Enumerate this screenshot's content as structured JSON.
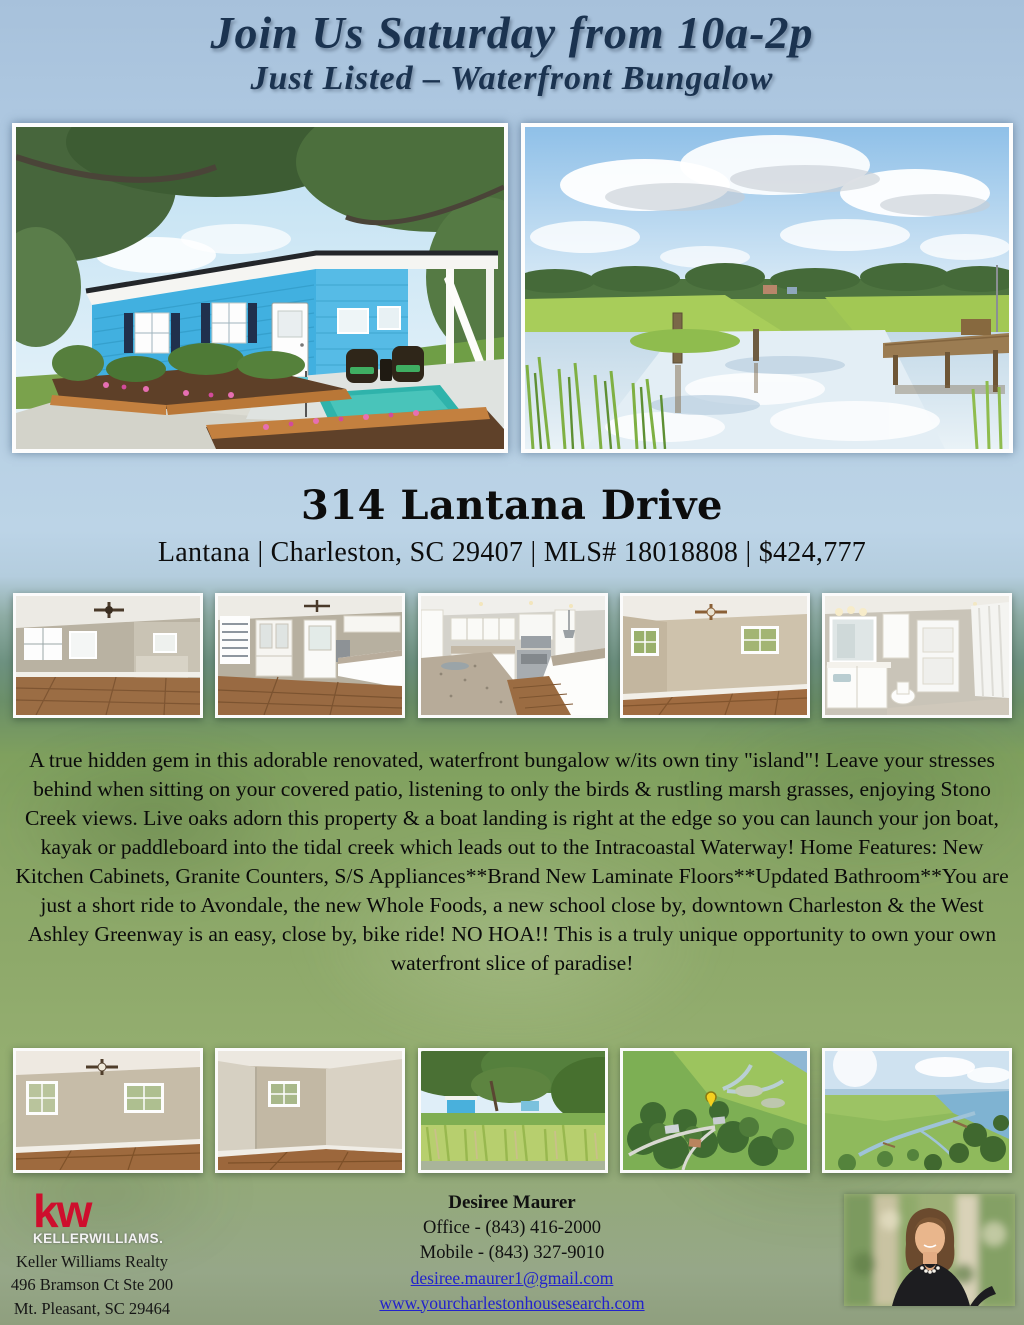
{
  "page": {
    "header": {
      "line1": "Join Us Saturday from 10a-2p",
      "line2": "Just Listed – Waterfront Bungalow"
    },
    "address": {
      "title": "314 Lantana Drive",
      "meta": "Lantana | Charleston, SC 29407 | MLS# 18018808 | $424,777"
    },
    "description": "A true hidden gem in this adorable renovated, waterfront bungalow w/its own tiny \"island\"! Leave your stresses behind when sitting on your covered patio, listening to only the birds & rustling marsh grasses, enjoying Stono Creek views. Live oaks adorn this property & a boat landing is right at the edge so you can launch your jon boat, kayak or paddleboard into the tidal creek which leads out to the Intracoastal Waterway! Home Features: New Kitchen Cabinets, Granite Counters, S/S Appliances**Brand New Laminate Floors**Updated Bathroom**You are just a short ride to Avondale, the new Whole Foods, a new school close by, downtown Charleston & the West Ashley Greenway is an easy, close by, bike ride! NO HOA!! This is a truly unique opportunity to own your own waterfront slice of paradise!",
    "gallery": {
      "main": [
        {
          "label": "blue waterfront bungalow exterior with carport, patio and landscaped beds"
        },
        {
          "label": "tidal creek and marsh view with wooden dock under cloudy blue sky"
        }
      ],
      "row1": [
        {
          "label": "living room with laminate floors and ceiling fan"
        },
        {
          "label": "dining area with built-in hutch, back door and kitchen beyond"
        },
        {
          "label": "renovated white kitchen with granite counters and stainless range"
        },
        {
          "label": "bedroom with ceiling fan and two windows"
        },
        {
          "label": "updated bathroom with white vanity and mirror"
        }
      ],
      "row2": [
        {
          "label": "bedroom with ceiling fan and laminate floors"
        },
        {
          "label": "bedroom with single window and laminate floors"
        },
        {
          "label": "marsh grass view toward the house and live oaks"
        },
        {
          "label": "aerial view of neighborhood, marsh and tidal creek with location marker"
        },
        {
          "label": "aerial view of marsh, winding creek and Intracoastal Waterway"
        }
      ]
    },
    "footer": {
      "brokerage": {
        "logo_kw": "kw",
        "logo_name": "KELLERWILLIAMS.",
        "address_lines": [
          "Keller Williams Realty",
          "496 Bramson Ct Ste 200",
          "Mt. Pleasant, SC 29464"
        ]
      },
      "agent": {
        "name": "Desiree Maurer",
        "office_phone": "Office - (843) 416-2000",
        "mobile_phone": "Mobile - (843) 327-9010",
        "email": "desiree.maurer1@gmail.com",
        "website": "www.yourcharlestonhousesearch.com",
        "headshot_label": "agent headshot portrait"
      }
    },
    "colors": {
      "header_text": "#1b3350",
      "kw_red": "#ce0e2d",
      "link_blue": "#2222cc",
      "house_blue": "#45b2e2"
    }
  }
}
